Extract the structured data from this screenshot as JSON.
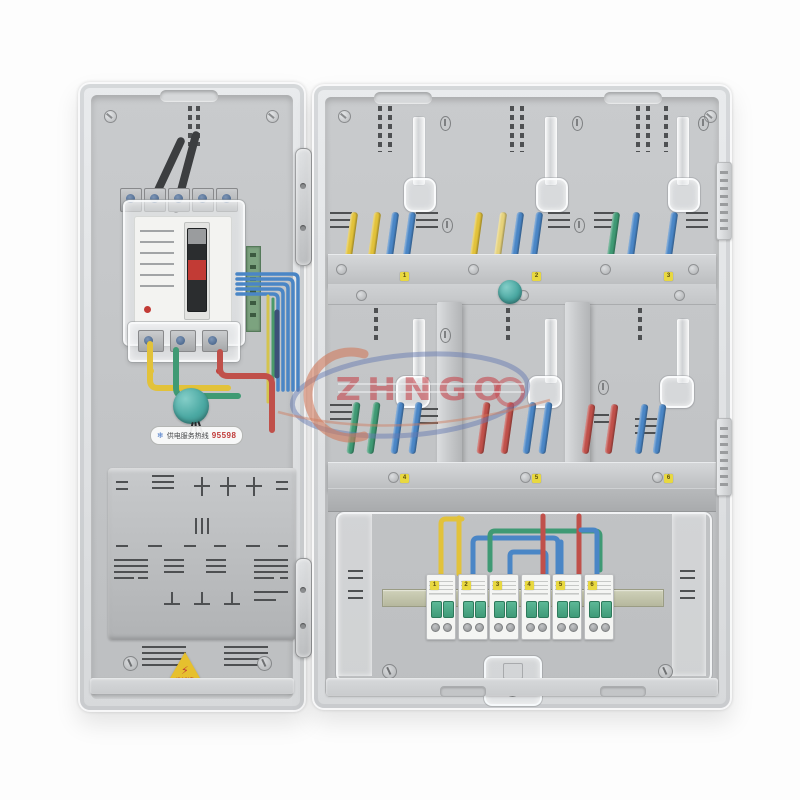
{
  "image_type": "product-photo",
  "subject": "transparent prepaid electric meter distribution box with main breaker and six mini circuit breakers",
  "watermark": {
    "text": "ZHNGO"
  },
  "left_door": {
    "hotline_label": "供电服务热线",
    "hotline_number": "95598",
    "warning_symbol": "⚡",
    "warning_text": "当心触电"
  },
  "right_door": {
    "meter_bay_tags": [
      "1",
      "2",
      "3",
      "4",
      "5",
      "6"
    ],
    "mcb_tags": [
      "1",
      "2",
      "3",
      "4",
      "5",
      "6"
    ]
  },
  "colors": {
    "wire_yellow": "#e2c23a",
    "wire_pale_yellow": "#e6d27a",
    "wire_blue": "#4a86c6",
    "wire_green": "#3f9a74",
    "wire_red": "#c0504a",
    "wire_navy": "#3c5078",
    "seal_teal": "#4aaaa4",
    "mcb_toggle_green": "#4aa886",
    "breaker_toggle_red": "#c23b35",
    "tag_yellow": "#e8d840",
    "warning_yellow": "#e6c02e",
    "watermark_red": "#c4464c",
    "watermark_blue": "#687cb2",
    "watermark_orange": "#d07a5c"
  }
}
